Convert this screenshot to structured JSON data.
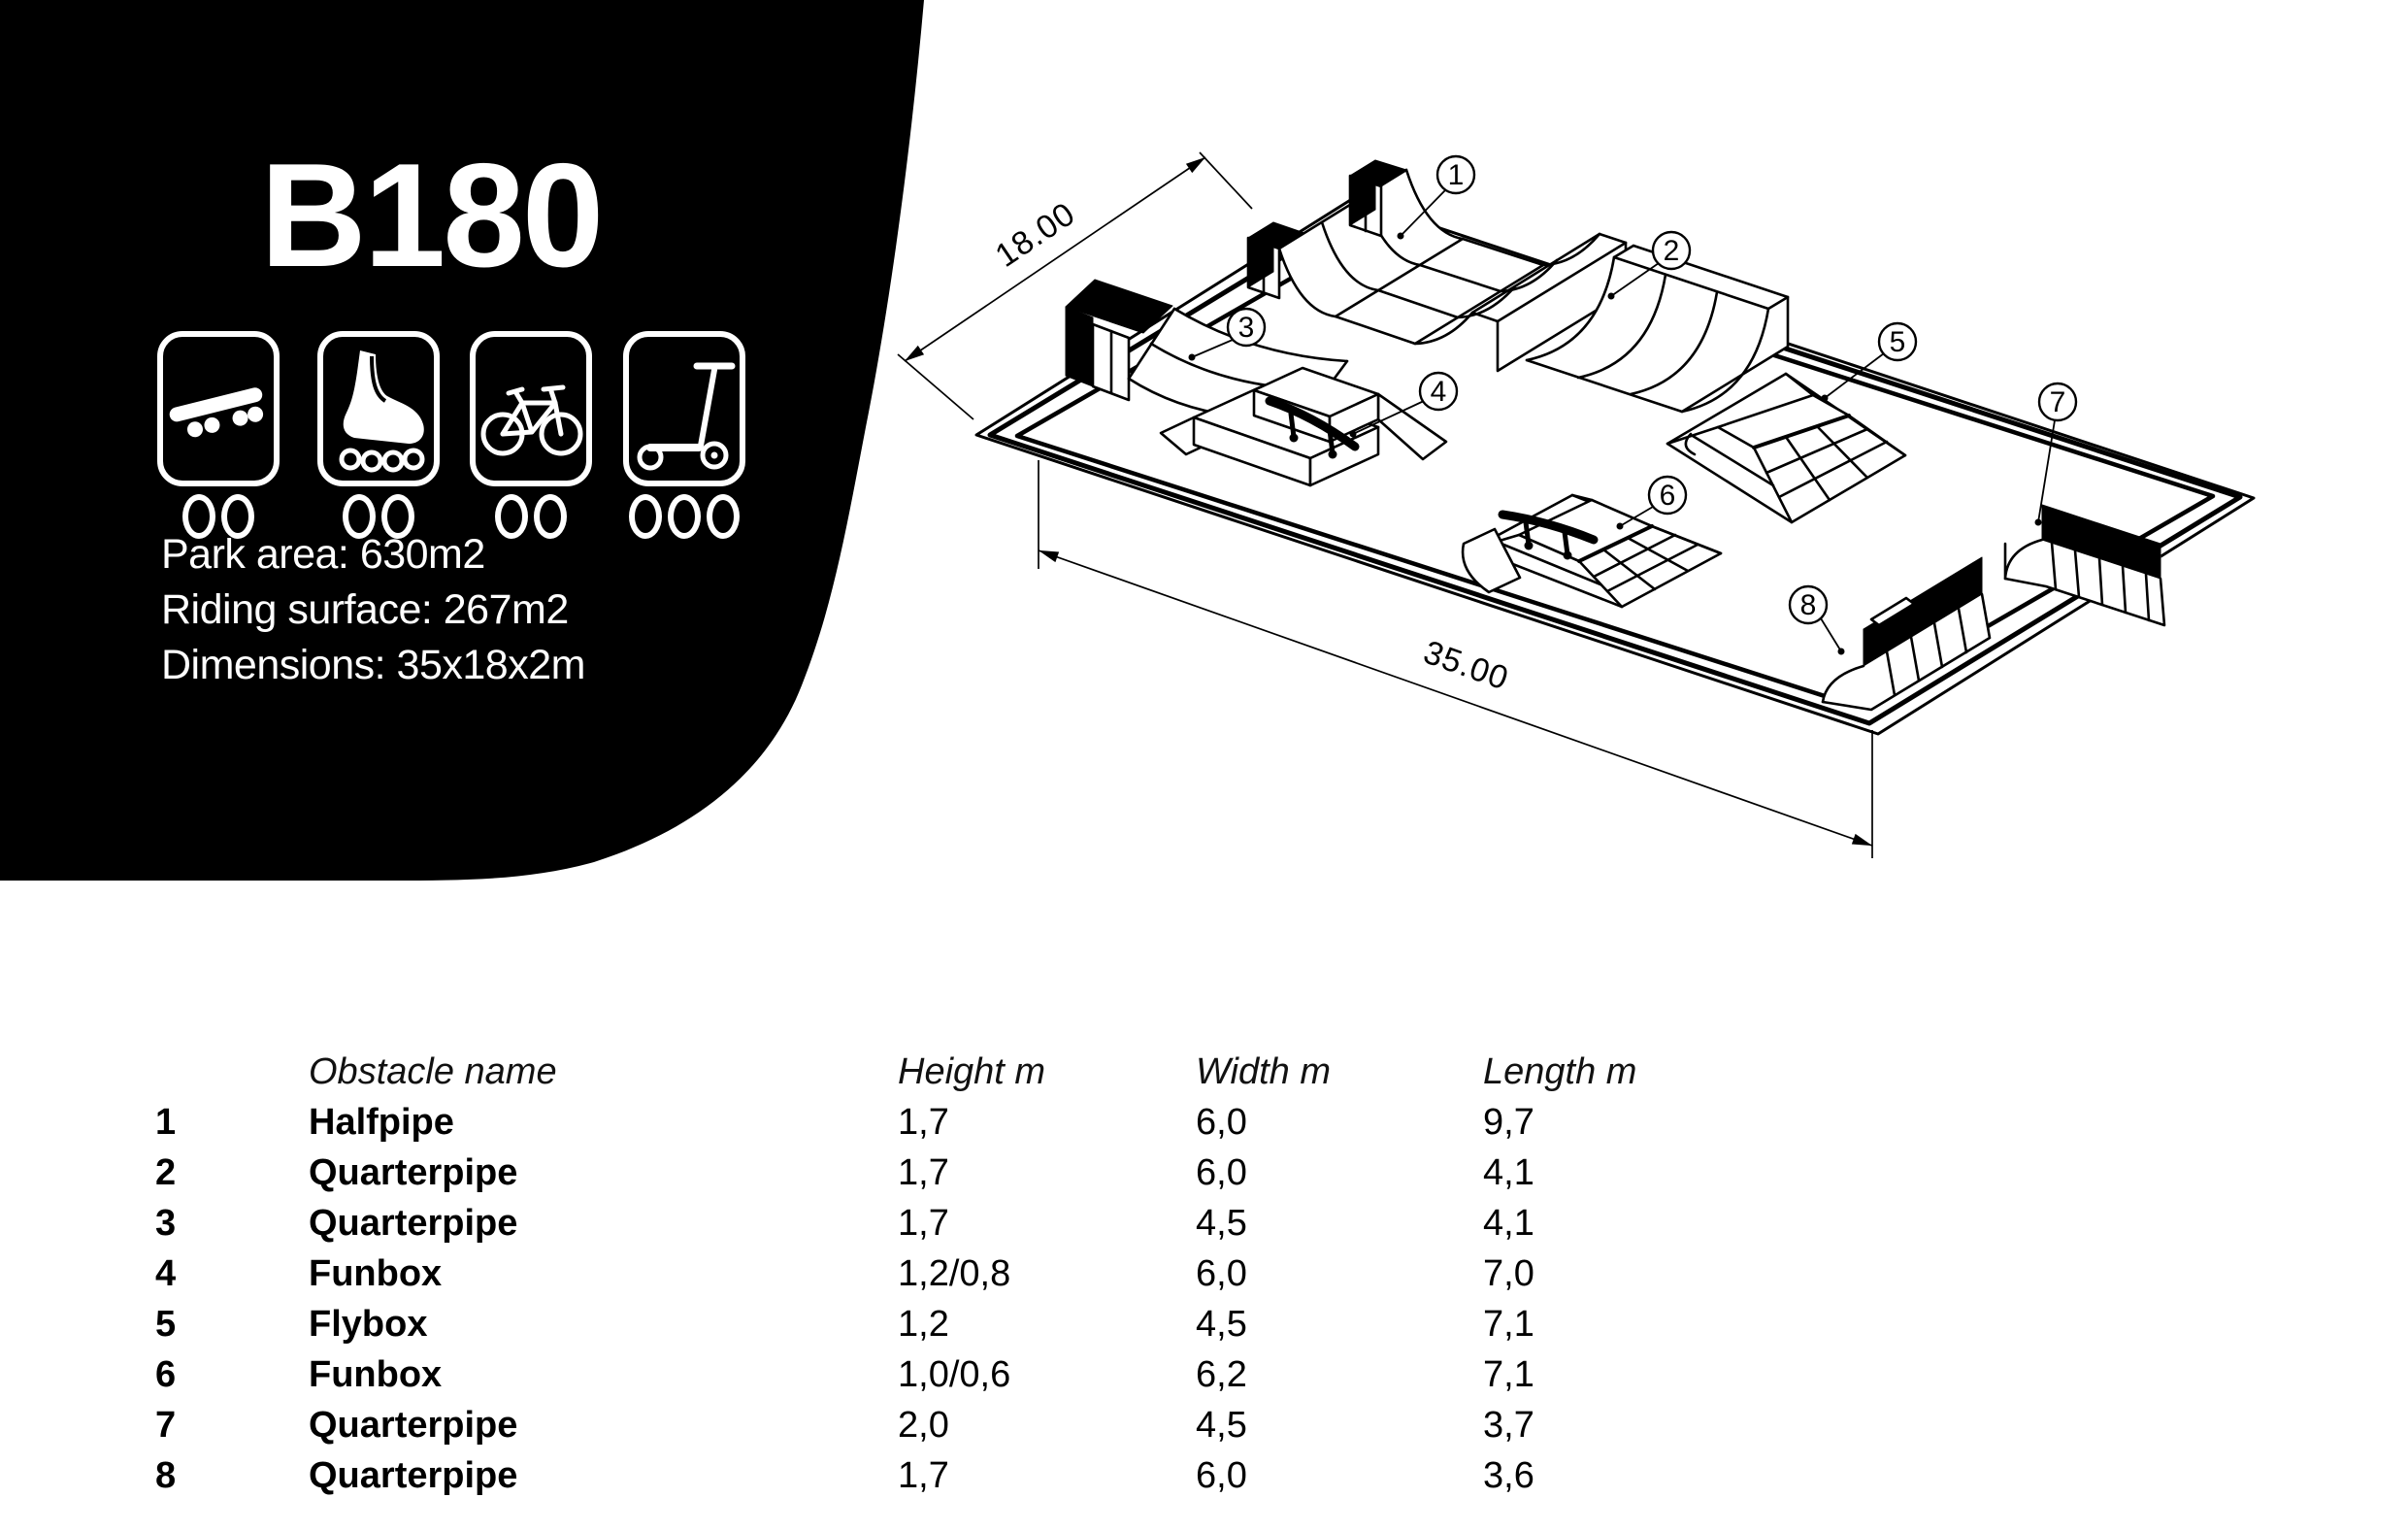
{
  "panel": {
    "title": "B180",
    "specs": [
      "Park area: 630m2",
      "Riding surface: 267m2",
      "Dimensions: 35x18x2m"
    ],
    "icons": [
      {
        "name": "skateboard",
        "difficulty_wheels": 2
      },
      {
        "name": "inline-skates",
        "difficulty_wheels": 2
      },
      {
        "name": "bmx-bike",
        "difficulty_wheels": 2
      },
      {
        "name": "scooter",
        "difficulty_wheels": 3
      }
    ],
    "colors": {
      "panel_bg": "#000000",
      "panel_text": "#ffffff"
    }
  },
  "drawing": {
    "width_label": "18.00",
    "length_label": "35.00",
    "callouts": [
      "1",
      "2",
      "3",
      "4",
      "5",
      "6",
      "7",
      "8"
    ]
  },
  "table": {
    "headers": {
      "name": "Obstacle name",
      "height": "Height m",
      "width": "Width m",
      "length": "Length m"
    },
    "rows": [
      {
        "num": "1",
        "name": "Halfpipe",
        "height": "1,7",
        "width": "6,0",
        "length": "9,7"
      },
      {
        "num": "2",
        "name": "Quarterpipe",
        "height": "1,7",
        "width": "6,0",
        "length": "4,1"
      },
      {
        "num": "3",
        "name": "Quarterpipe",
        "height": "1,7",
        "width": "4,5",
        "length": "4,1"
      },
      {
        "num": "4",
        "name": "Funbox",
        "height": "1,2/0,8",
        "width": "6,0",
        "length": "7,0"
      },
      {
        "num": "5",
        "name": "Flybox",
        "height": "1,2",
        "width": "4,5",
        "length": "7,1"
      },
      {
        "num": "6",
        "name": "Funbox",
        "height": "1,0/0,6",
        "width": "6,2",
        "length": "7,1"
      },
      {
        "num": "7",
        "name": "Quarterpipe",
        "height": "2,0",
        "width": "4,5",
        "length": "3,7"
      },
      {
        "num": "8",
        "name": "Quarterpipe",
        "height": "1,7",
        "width": "6,0",
        "length": "3,6"
      }
    ]
  }
}
